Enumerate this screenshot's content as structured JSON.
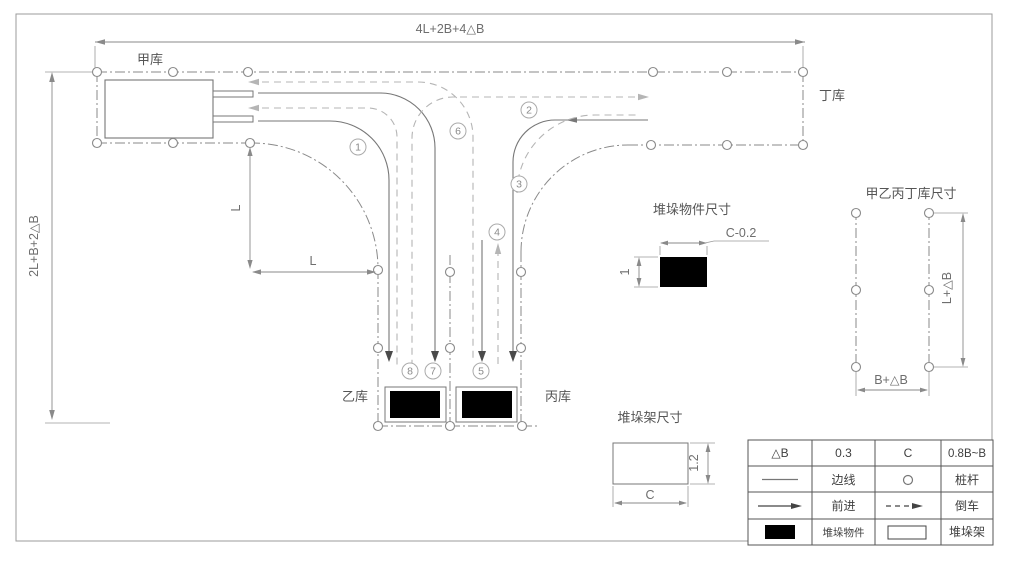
{
  "course": {
    "dim_top": "4L+2B+4△B",
    "dim_left": "2L+B+2△B",
    "dim_l_vertical": "L",
    "dim_l_horizontal": "L",
    "warehouse_a": "甲库",
    "warehouse_b": "乙库",
    "warehouse_c": "丙库",
    "warehouse_d": "丁库"
  },
  "routes": [
    {
      "num": "1"
    },
    {
      "num": "2"
    },
    {
      "num": "3"
    },
    {
      "num": "4"
    },
    {
      "num": "5"
    },
    {
      "num": "6"
    },
    {
      "num": "7"
    },
    {
      "num": "8"
    }
  ],
  "details": {
    "stack_object": {
      "title": "堆垛物件尺寸",
      "width_dim": "C-0.2",
      "height_dim": "1"
    },
    "stack_rack": {
      "title": "堆垛架尺寸",
      "width_dim": "C",
      "height_dim": "1.2"
    },
    "warehouse_size": {
      "title": "甲乙丙丁库尺寸",
      "height_dim": "L+△B",
      "width_dim": "B+△B"
    }
  },
  "legend": {
    "rows": [
      {
        "c0": "△B",
        "c1": "0.3",
        "c2": "C",
        "c3": "0.8B~B"
      },
      {
        "c1": "边线",
        "c3": "桩杆"
      },
      {
        "c1": "前进",
        "c3": "倒车"
      },
      {
        "c1": "堆垛物件",
        "c3": "堆垛架"
      }
    ]
  },
  "colors": {
    "edge_line": "#777777",
    "centerline": "#8a8a8a",
    "reverse_dashed": "#b5b5b5",
    "object_fill": "#000000",
    "table_border": "#555555"
  }
}
